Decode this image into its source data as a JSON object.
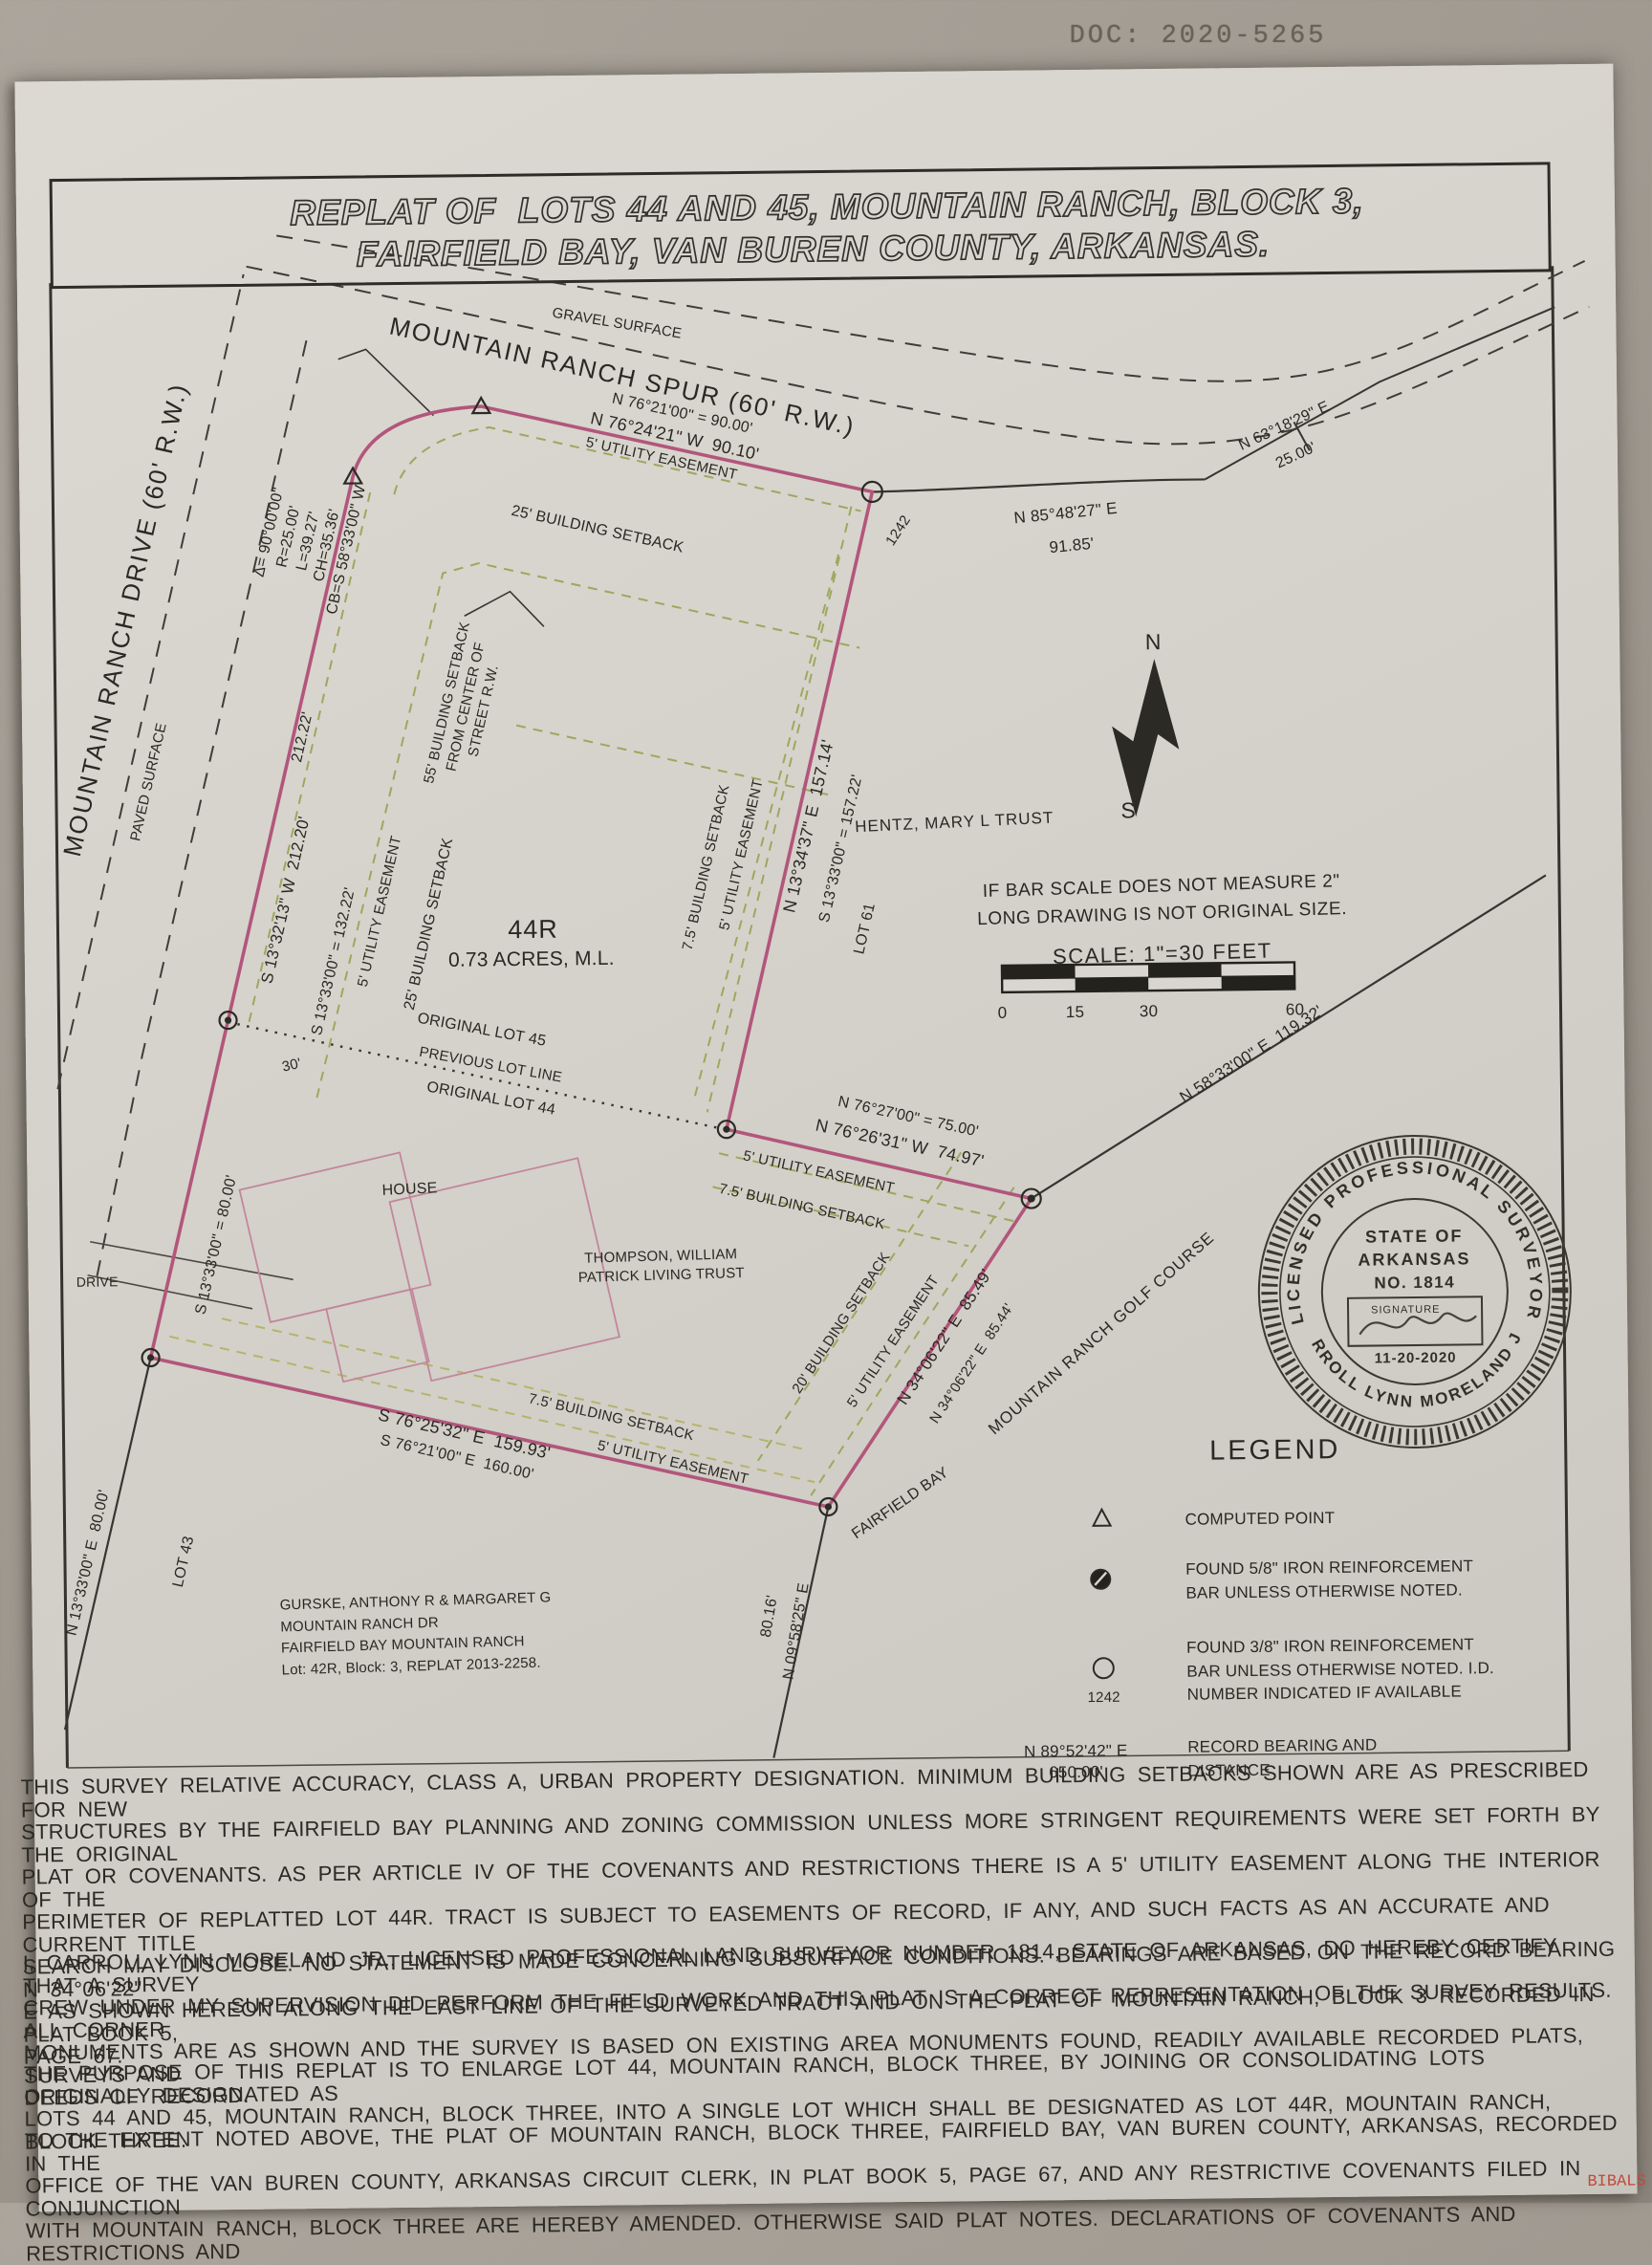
{
  "doc_number": "DOC: 2020-5265",
  "corner_stamp": "BIBALS MG",
  "title": {
    "line1": "REPLAT OF  LOTS 44 AND 45, MOUNTAIN RANCH, BLOCK 3,",
    "line2": "FAIRFIELD BAY, VAN BUREN COUNTY, ARKANSAS."
  },
  "colors": {
    "boundary_pink": "#b2567c",
    "easement_olive": "#9aa95e",
    "linework_black": "#37352f",
    "paper": "#d6d3cc"
  },
  "roads": {
    "spur": "MOUNTAIN RANCH SPUR (60' R.W.)",
    "drive": "MOUNTAIN RANCH DRIVE (60' R.W.)",
    "gravel": "GRAVEL SURFACE",
    "paved": "PAVED SURFACE",
    "driveway": "DRIVE",
    "fairfield_bay": "FAIRFIELD BAY"
  },
  "bearings": {
    "top_record": "N 76°21'00\" = 90.00'",
    "top": "N 76°24'21\" W  90.10'",
    "ne": "N 85°48'27\" E",
    "ne_dist": "91.85'",
    "ne2": "N 63°18'29\" E",
    "ne2_dist": "25.00'",
    "west": "S 13°32'13\" W  212.20'",
    "west_record": "212.22'",
    "west2_record": "S 13°33'00\" = 132.22'",
    "east": "N 13°34'37\" E  157.14'",
    "east_record": "S 13°33'00\" = 157.22'",
    "mid_record": "N 76°27'00\" = 75.00'",
    "mid": "N 76°26'31\" W  74.97'",
    "golf": "N 58°33'00\" E  119.32'",
    "se": "N 34°06'22\" E  85.49'",
    "se_record": "N 34°06'22\" E  85.44'",
    "sw_80": "S 13°33'00\" = 80.00'",
    "sw2": "N 13°33'00\" E  80.00'",
    "bottom": "S 76°25'32\" E  159.93'",
    "bottom_record": "S 76°21'00\" E  160.00'",
    "s_8016": "80.16'",
    "s_0958": "N 09°58'25\" E",
    "dim_30": "30'"
  },
  "curve_data": "Δ= 90°00'00\"\nR=25.00'\nL=39.27'\nCH=35.36'\nCB=S 58°33'00\" W",
  "easements": {
    "utility_5": "5' UTILITY EASEMENT",
    "setback_25": "25' BUILDING SETBACK",
    "setback_75": "7.5' BUILDING SETBACK",
    "setback_20": "20' BUILDING SETBACK",
    "setback_55": "55' BUILDING SETBACK\nFROM CENTER OF\nSTREET R.W."
  },
  "lot": {
    "number": "44R",
    "area": "0.73 ACRES, M.L.",
    "original_45": "ORIGINAL LOT 45",
    "previous_line": "PREVIOUS LOT LINE",
    "original_44": "ORIGINAL LOT 44",
    "lot_61": "LOT 61",
    "lot_43": "LOT 43",
    "point_id": "1242",
    "house": "HOUSE"
  },
  "owners": {
    "hentz": "HENTZ, MARY L TRUST",
    "thompson": "THOMPSON, WILLIAM\nPATRICK LIVING TRUST",
    "golf_course": "MOUNTAIN RANCH GOLF COURSE",
    "gurske": "GURSKE, ANTHONY R & MARGARET G\nMOUNTAIN RANCH DR\nFAIRFIELD BAY  MOUNTAIN RANCH\nLot: 42R, Block: 3, REPLAT 2013-2258."
  },
  "scale": {
    "warning": "IF BAR SCALE DOES NOT MEASURE 2\"\nLONG DRAWING IS NOT ORIGINAL SIZE.",
    "text": "SCALE: 1\"=30 FEET",
    "tick_0": "0",
    "tick_15": "15",
    "tick_30": "30",
    "tick_60": "60"
  },
  "north": {
    "n": "N",
    "s": "S"
  },
  "legend": {
    "title": "LEGEND",
    "computed": "COMPUTED POINT",
    "found58": "FOUND 5/8\" IRON REINFORCEMENT\nBAR UNLESS OTHERWISE NOTED.",
    "found38": "FOUND 3/8\" IRON REINFORCEMENT\nBAR UNLESS OTHERWISE NOTED. I.D.\nNUMBER INDICATED IF AVAILABLE",
    "found38_id": "1242",
    "record_bearing": "N 89°52'42\" E\n650.00'",
    "record_label": "RECORD BEARING AND\nDISTANCE"
  },
  "seal": {
    "ring_top": "LICENSED PROFESSIONAL SURVEYOR",
    "ring_bottom": "CARROLL LYNN MORELAND JR.",
    "state1": "STATE OF",
    "state2": "ARKANSAS",
    "number": "NO. 1814",
    "signature_label": "SIGNATURE",
    "date": "11-20-2020"
  },
  "notes": {
    "p1": "THIS SURVEY RELATIVE ACCURACY, CLASS A, URBAN PROPERTY DESIGNATION.  MINIMUM BUILDING SETBACKS SHOWN ARE AS PRESCRIBED FOR NEW\nSTRUCTURES BY THE FAIRFIELD BAY PLANNING AND ZONING COMMISSION UNLESS MORE STRINGENT REQUIREMENTS WERE SET FORTH BY THE ORIGINAL\nPLAT OR COVENANTS.  AS PER ARTICLE IV OF THE COVENANTS AND RESTRICTIONS THERE IS A 5' UTILITY EASEMENT ALONG THE INTERIOR OF THE\nPERIMETER OF REPLATTED LOT 44R.  TRACT IS SUBJECT TO EASEMENTS OF RECORD, IF ANY, AND SUCH FACTS AS AN ACCURATE AND CURRENT TITLE\nSEARCH MAY DISCLOSE.  NO STATEMENT IS MADE CONCERNING SUBSURFACE CONDITIONS.  BEARINGS ARE BASED ON THE RECORD BEARING N 34°06'22\"\nE AS SHOWN HEREON ALONG THE EAST LINE OF THE SURVEYED TRACT AND ON THE PLAT OF MOUNTAIN RANCH, BLOCK 3 RECORDED IN PLAT BOOK 5,\nPAGE 67.",
    "p2": "I, CARROLL LYNN MORELAND JR., LICENSED PROFESSIONAL LAND SURVEYOR NUMBER 1814, STATE OF ARKANSAS, DO HEREBY CERTIFY THAT A SURVEY\nCREW UNDER MY SUPERVISION DID PERFORM THE FIELD WORK AND THIS PLAT IS A CORRECT REPRESENTATION OF THE SURVEY RESULTS.  ALL CORNER\nMONUMENTS ARE AS SHOWN AND THE SURVEY IS BASED ON EXISTING AREA MONUMENTS FOUND, READILY AVAILABLE RECORDED PLATS, SURVEYS AND\nDEEDS OF RECORD.",
    "p3": "THE PURPOSE OF THIS REPLAT IS TO ENLARGE LOT 44, MOUNTAIN RANCH, BLOCK THREE, BY JOINING OR CONSOLIDATING LOTS ORIGINALLY DESIGNATED AS\nLOTS 44 AND 45, MOUNTAIN RANCH, BLOCK THREE, INTO A SINGLE LOT WHICH SHALL BE DESIGNATED AS LOT 44R, MOUNTAIN RANCH, BLOCK THREE.",
    "p4": "TO THE EXTENT NOTED ABOVE, THE PLAT OF MOUNTAIN RANCH, BLOCK THREE, FAIRFIELD BAY, VAN BUREN COUNTY, ARKANSAS, RECORDED IN THE\nOFFICE OF THE VAN BUREN COUNTY, ARKANSAS CIRCUIT CLERK, IN PLAT BOOK 5, PAGE 67, AND ANY RESTRICTIVE COVENANTS FILED IN CONJUNCTION\nWITH MOUNTAIN RANCH, BLOCK THREE ARE HEREBY AMENDED. OTHERWISE SAID PLAT NOTES. DECLARATIONS OF COVENANTS AND RESTRICTIONS AND"
  }
}
